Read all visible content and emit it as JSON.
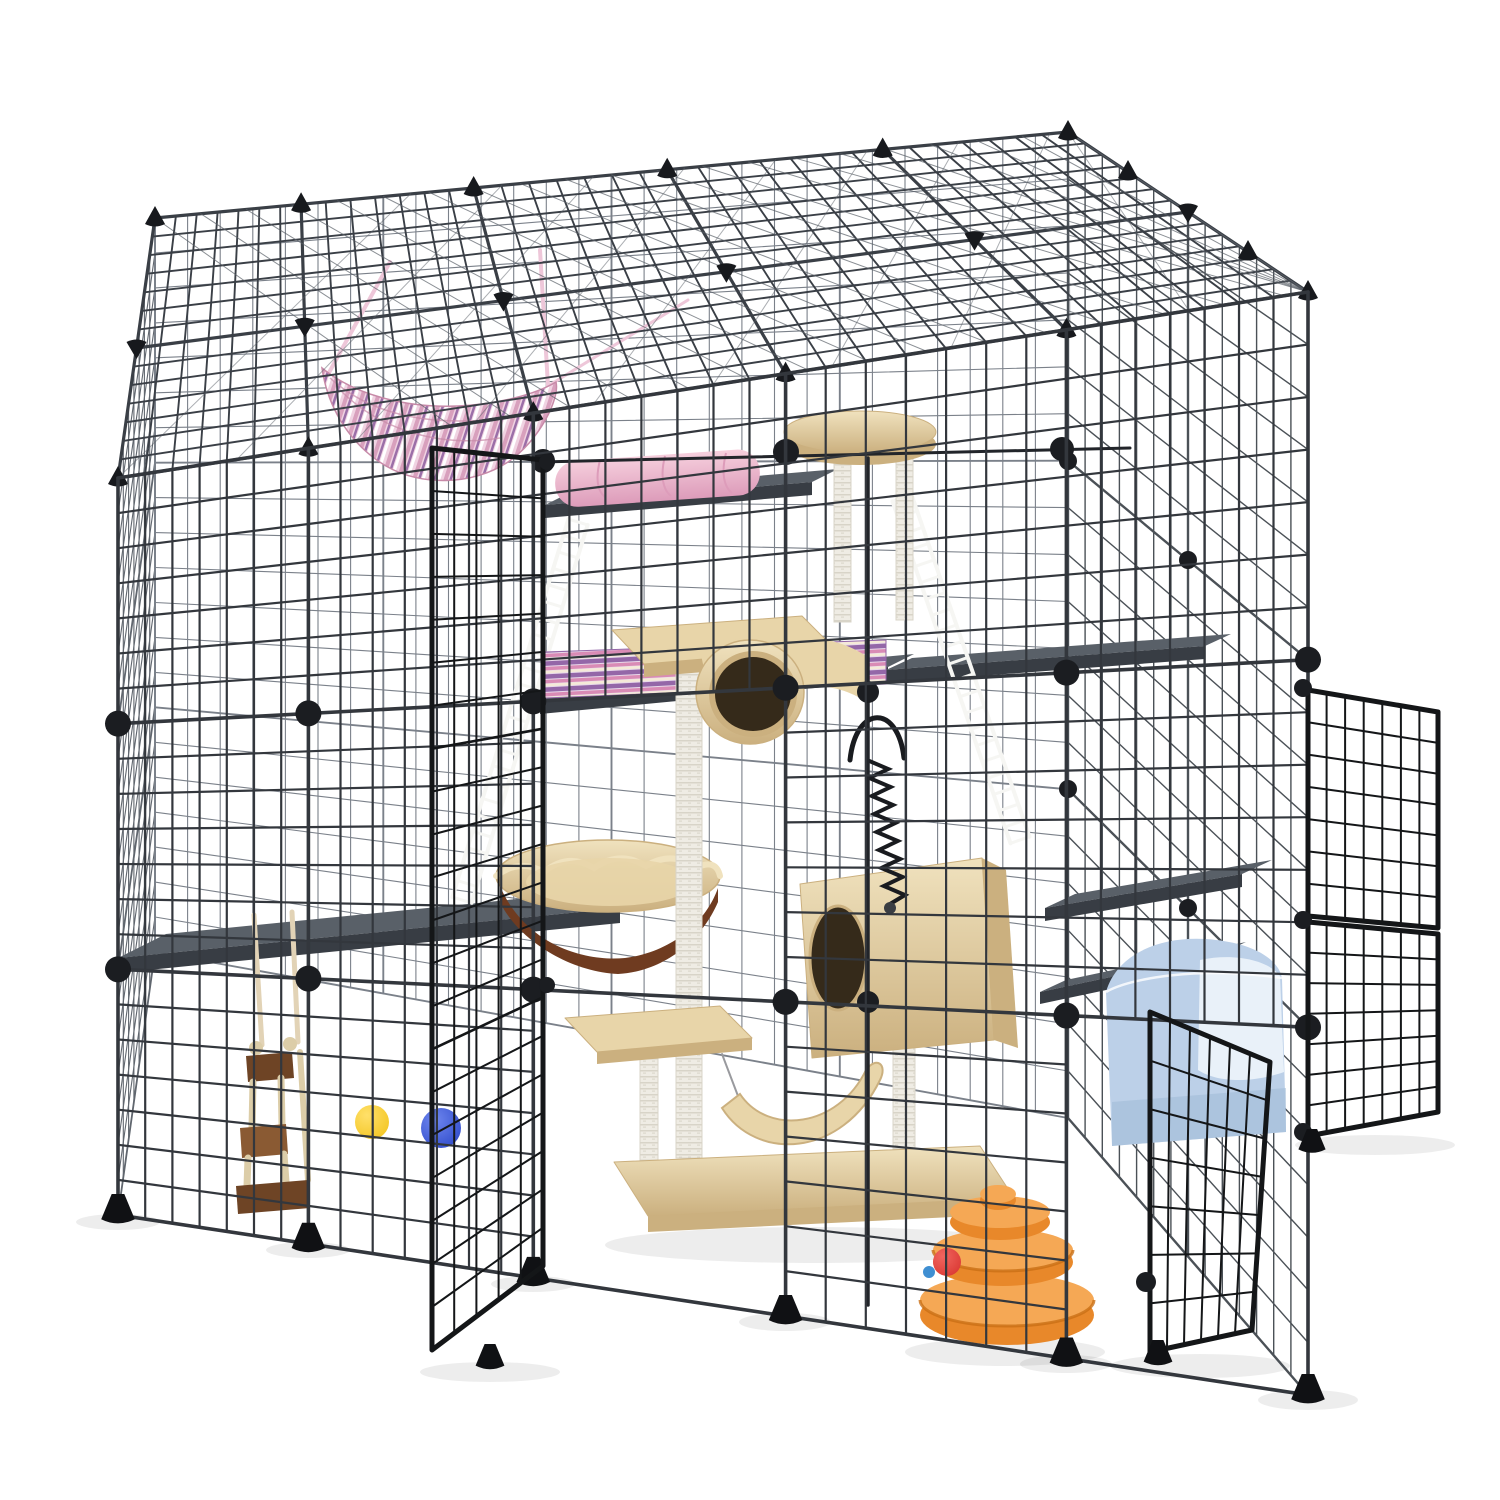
{
  "scene": {
    "title": "Large DIY metal wire cat cage playpen with cat tree, hammock, ladders, shelves and toys on a white background"
  },
  "colors": {
    "background": "#ffffff",
    "wire_front": "#33373d",
    "wire_back": "#7b818a",
    "wire_right": "#4b5157",
    "wire_left": "#60666e",
    "wire_roof": "#3a3f46",
    "roof_sheen": "#5a6068",
    "frame_bar": "#22252a",
    "connector": "#1b1d21",
    "cap": "#17191d",
    "foot": "#101114",
    "door_wire": "#141618",
    "shelf_top": "#596068",
    "shelf_side": "#383d44",
    "ladder": "#f6f6f3",
    "hammock_base": "#f0d3e2",
    "hammock_stripe1": "#d8a0bd",
    "hammock_stripe2": "#9b6fa8",
    "hammock_stripe3": "#ffffff",
    "hammock_strap": "#eec7d9",
    "hammock_edge": "#c78aa8",
    "cushion_pink": "#f6cfdd",
    "cushion_pink_dark": "#dd9cba",
    "mat_base": "#e8d9ea",
    "mat_stripe1": "#9467a8",
    "mat_stripe2": "#d98bb5",
    "mat_stripe3": "#f5ead8",
    "tree_plush": "#e8d5a9",
    "tree_plush_dark": "#cbb07f",
    "tree_plush_light": "#f0e2be",
    "tree_hole": "#352a1a",
    "basket_brown": "#6f3b20",
    "sisal_bg": "#efece4",
    "sisal_line": "#d8d4c8",
    "spring": "#191b1f",
    "wood_dark": "#6e4425",
    "wood_mid": "#8a5a33",
    "wood_light": "#dccda8",
    "strap_cream": "#e2d3b6",
    "ball_yellow": "#f2c31b",
    "ball_blue": "#2a46c8",
    "ball_red": "#d8342e",
    "dot_teal": "#3f8fd2",
    "tower_orange": "#e8882a",
    "tower_orange_light": "#f5a855",
    "tower_orange_dark": "#c96f15",
    "litter_blue": "#bcd0e8",
    "litter_blue_dark": "#9fb9d6",
    "litter_white": "#e9f1f9",
    "shadow": "rgba(0,0,0,0.07)"
  },
  "parts": [
    {
      "id": "cage-roof",
      "label": "wire roof panels"
    },
    {
      "id": "front-wall",
      "label": "front wire wall"
    },
    {
      "id": "back-wall",
      "label": "back wire wall"
    },
    {
      "id": "right-wall",
      "label": "right wire wall"
    },
    {
      "id": "left-wall",
      "label": "left wire wall"
    },
    {
      "id": "connector-balls",
      "label": "round panel connectors"
    },
    {
      "id": "edge-caps",
      "label": "corner cap connectors"
    },
    {
      "id": "feet",
      "label": "stabilizer feet"
    },
    {
      "id": "front-door",
      "label": "open front door panel"
    },
    {
      "id": "right-doors",
      "label": "open right door panels"
    },
    {
      "id": "tilted-door",
      "label": "open lower-right door panel"
    },
    {
      "id": "hammock",
      "label": "pink striped hanging hammock"
    },
    {
      "id": "pink-cushion",
      "label": "pink cushion roll"
    },
    {
      "id": "striped-mat",
      "label": "striped cushion mat"
    },
    {
      "id": "shelves",
      "label": "gray platform shelves"
    },
    {
      "id": "ladders",
      "label": "white wire ladders"
    },
    {
      "id": "cat-tree",
      "label": "beige cat tree with posts, tunnel, basket, condo and perch"
    },
    {
      "id": "spring-toy",
      "label": "black spring toy"
    },
    {
      "id": "wood-toy",
      "label": "hanging wooden ladder toy"
    },
    {
      "id": "yellow-ball",
      "label": "yellow ball"
    },
    {
      "id": "blue-ball",
      "label": "blue ball"
    },
    {
      "id": "ball-tower",
      "label": "orange ball-track tower with red ball"
    },
    {
      "id": "litter-box",
      "label": "light blue litter box"
    }
  ]
}
